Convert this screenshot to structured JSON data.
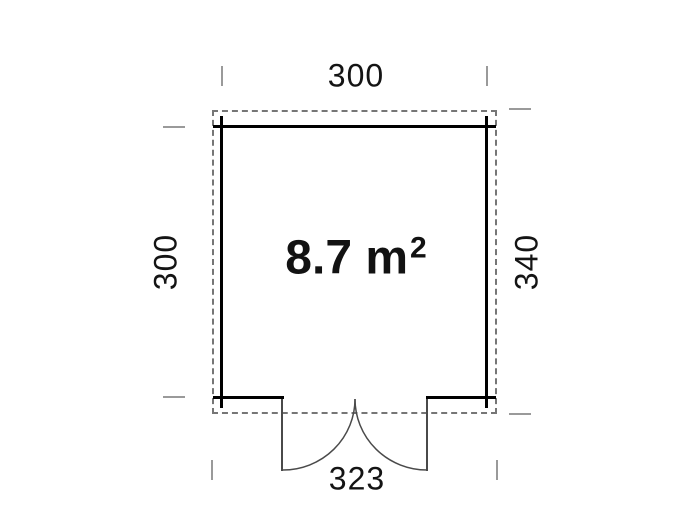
{
  "floorplan": {
    "area": {
      "value": "8.7 m",
      "superscript": "2"
    },
    "dimensions": {
      "top": "300",
      "left": "300",
      "right": "340",
      "bottom": "323"
    },
    "colors": {
      "wall": "#000000",
      "roof_dash": "#767676",
      "tick": "#9a9a9a",
      "door_line": "#4a4a4a",
      "text": "#141414",
      "background": "#ffffff"
    }
  }
}
